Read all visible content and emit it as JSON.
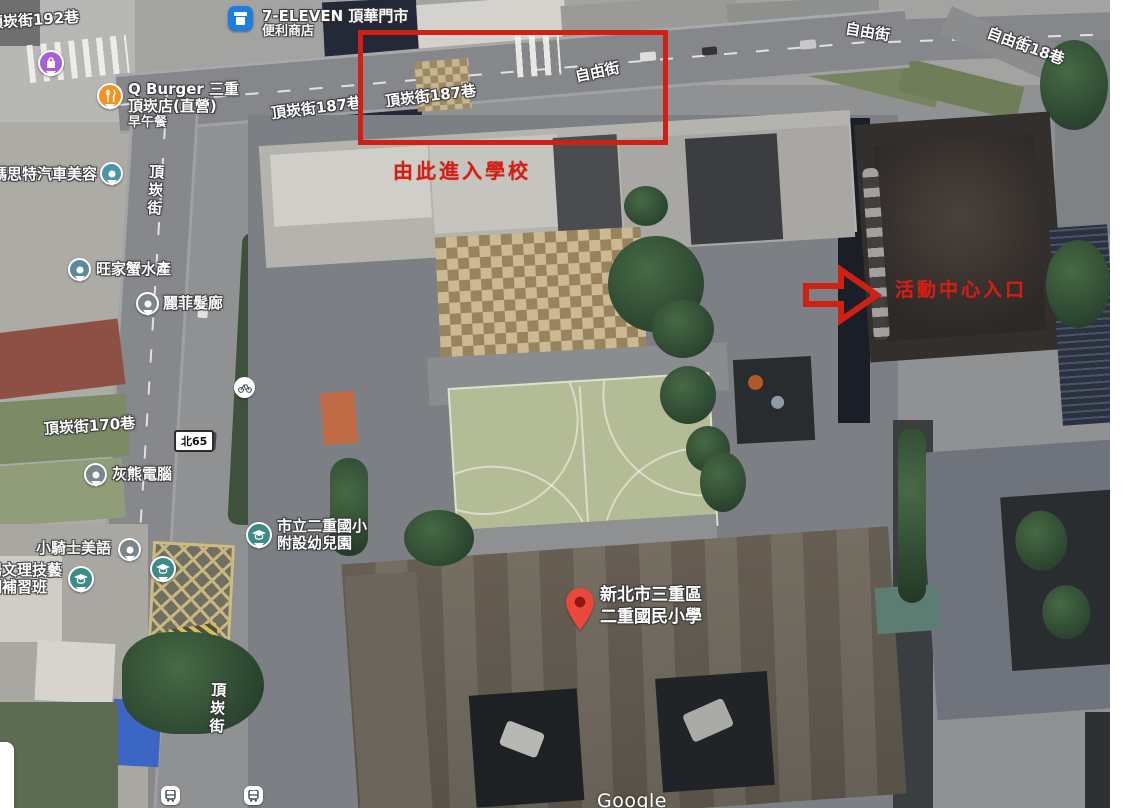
{
  "watermark": "Google",
  "annotations": {
    "entry_label": "由此進入學校",
    "activity_label": "活動中心入口"
  },
  "streets": {
    "dingkan192": "頂崁街192巷",
    "dingkan187_west": "頂崁街187巷",
    "dingkan187_box": "頂崁街187巷",
    "dingkan170": "頂崁街170巷",
    "dingkan_vertical_north": "頂崁街",
    "dingkan_vertical_south": "頂崁街",
    "ziyou_box": "自由街",
    "ziyou_east": "自由街",
    "ziyou18": "自由街18巷",
    "route_badge": "北65"
  },
  "pois": {
    "seven_eleven": {
      "name": "7-ELEVEN 頂華門市",
      "category": "便利商店"
    },
    "qburger": {
      "line1": "Q Burger 三重",
      "line2": "頂崁店(直營)",
      "line3": "早午餐"
    },
    "car_beauty": {
      "name": "瑪思特汽車美容"
    },
    "seafood": {
      "name": "旺家蟹水產"
    },
    "hair_salon": {
      "name": "麗菲髮廊"
    },
    "computer": {
      "name": "灰熊電腦"
    },
    "english_school": {
      "name": "小騎士美語"
    },
    "cram_school": {
      "line1": "場文理技藝",
      "line2": "期補習班"
    },
    "kindergarten": {
      "line1": "市立二重國小",
      "line2": "附設幼兒園"
    },
    "school_place": {
      "line1": "新北市三重區",
      "line2": "二重國民小學"
    }
  },
  "icons": {
    "seven_eleven": "convenience-store",
    "qburger": "restaurant",
    "shop_top_left": "shopping",
    "schools": "graduation-cap",
    "transit": "bus-stop",
    "bike": "bicycle",
    "place_marker": "red-map-pin"
  },
  "colors": {
    "annotation_red": "#d21f14",
    "place_pin_red": "#e9483a",
    "seven_blue": "#1c7fe0",
    "qburger_orange": "#f09423",
    "shop_purple": "#ab5fd6",
    "grad_teal": "#3d8b85",
    "poi_teal": "#4a96a6",
    "poi_gray": "#7a868c",
    "tarp_blue": "#3b66c4"
  }
}
